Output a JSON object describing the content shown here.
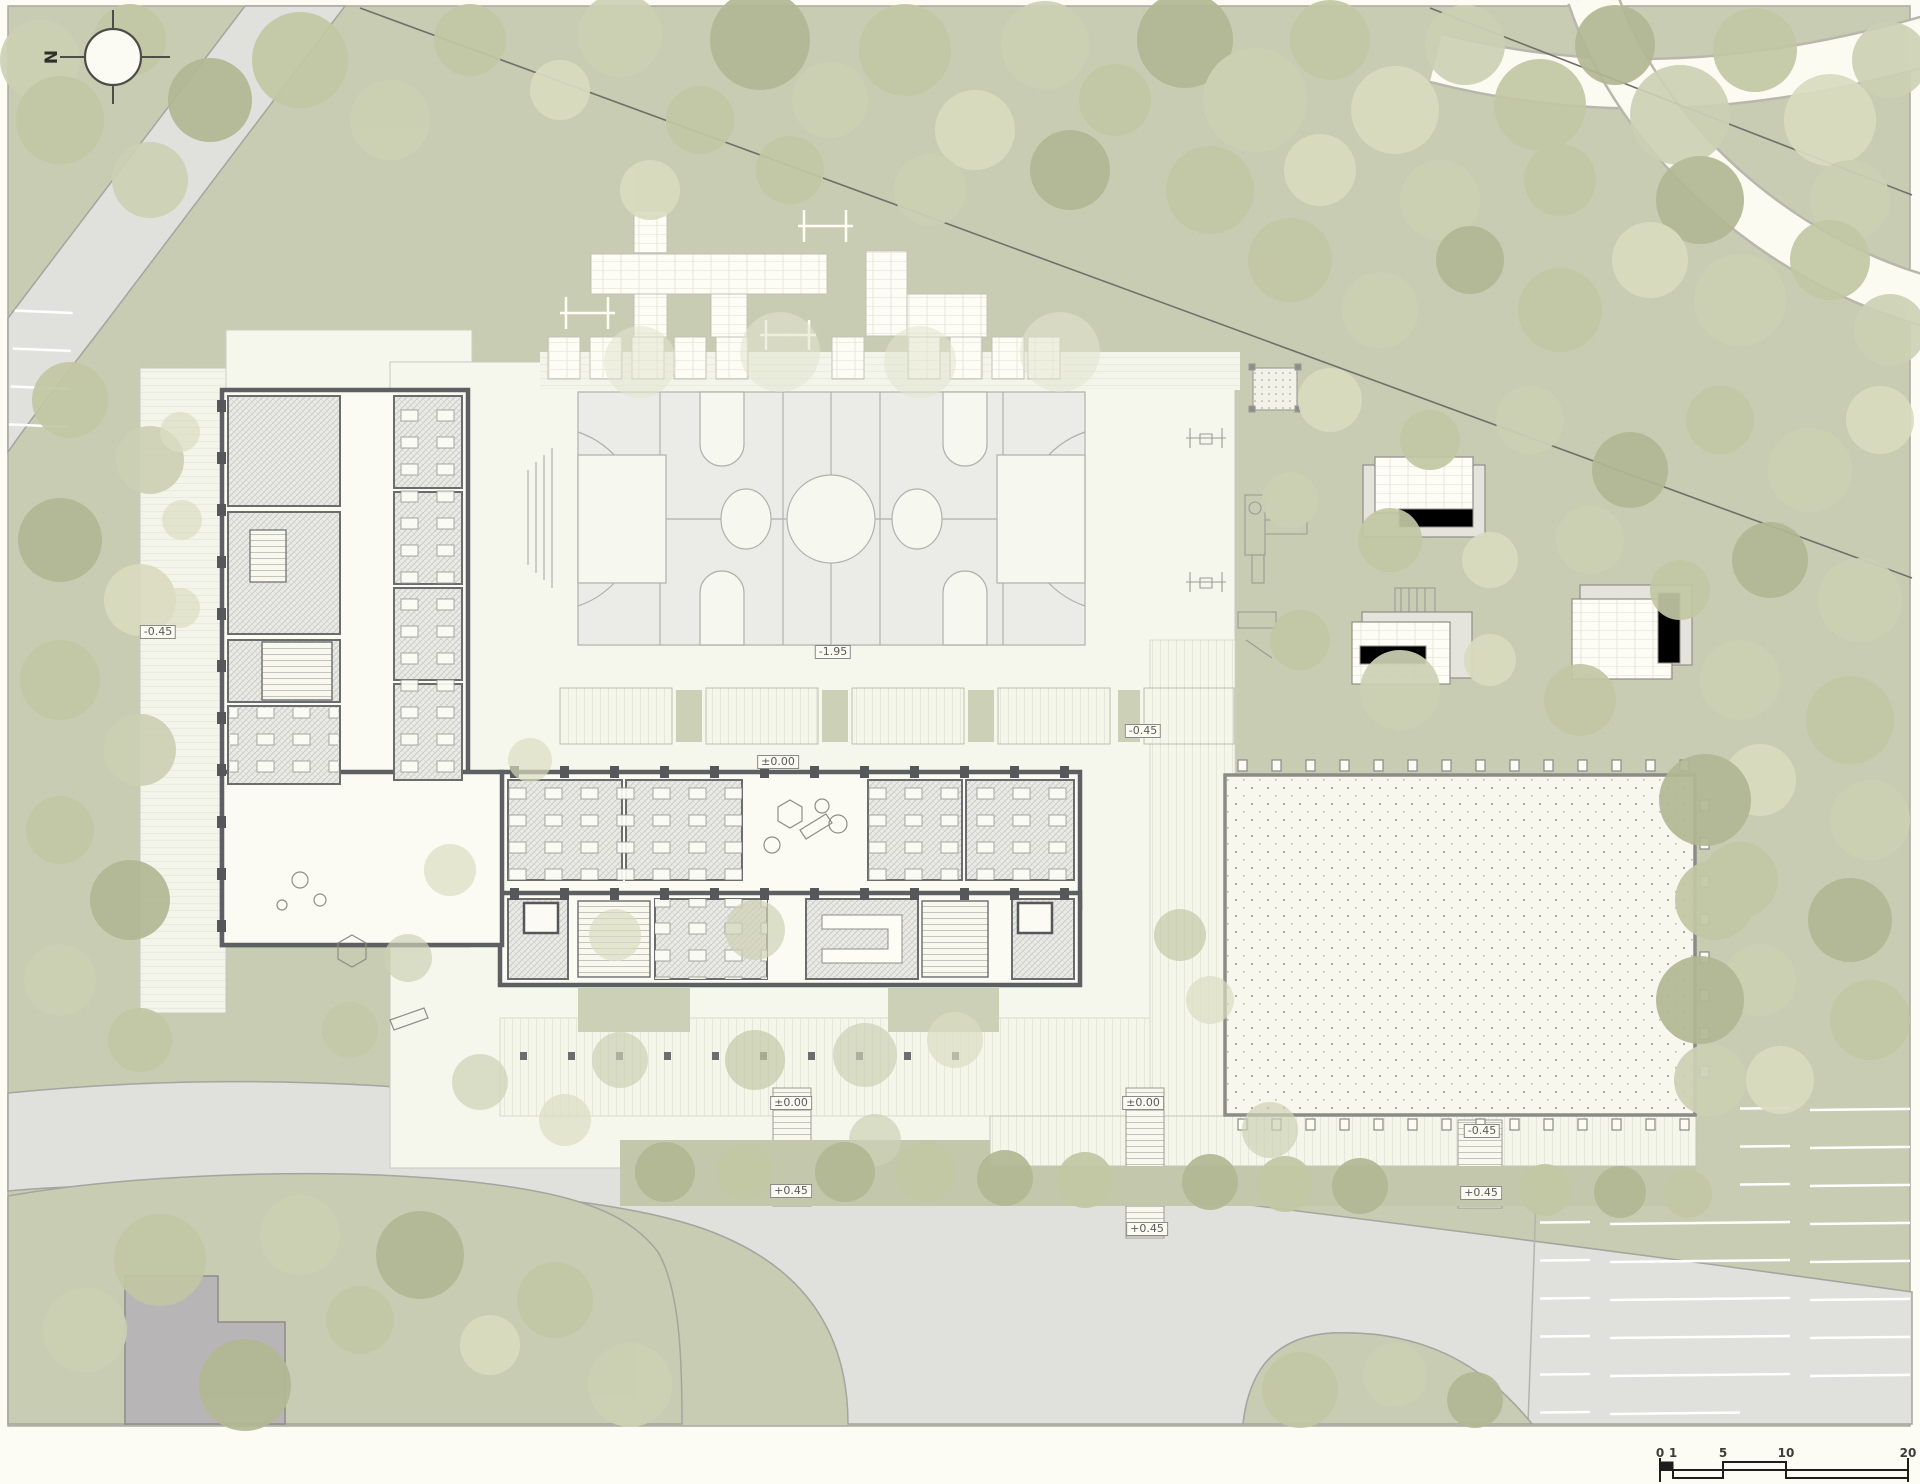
{
  "plan": {
    "type": "architectural-site-plan",
    "north": {
      "label": "N"
    },
    "colors": {
      "site_green": "#c8ccb2",
      "paving_ivory": "#f6f7ec",
      "road_gray": "#e0e1dc",
      "court_gray": "#ebece8",
      "wall_dark": "#5d5f62",
      "tree_olive": "#b2b894",
      "neighbor_building_gray": "#b8b5b6",
      "paper": "#fcfcf4"
    },
    "elevation_labels": [
      {
        "id": "west-forecourt",
        "text": "-0.45",
        "x": 158,
        "y": 632
      },
      {
        "id": "sports-court",
        "text": "-1.95",
        "x": 833,
        "y": 652
      },
      {
        "id": "east-walkway",
        "text": "-0.45",
        "x": 1143,
        "y": 731
      },
      {
        "id": "north-terrace",
        "text": "±0.00",
        "x": 778,
        "y": 762
      },
      {
        "id": "south-ramp-1-top",
        "text": "±0.00",
        "x": 791,
        "y": 1103
      },
      {
        "id": "south-ramp-1-bottom",
        "text": "+0.45",
        "x": 791,
        "y": 1191
      },
      {
        "id": "south-ramp-2-top",
        "text": "±0.00",
        "x": 1143,
        "y": 1103
      },
      {
        "id": "south-ramp-2-bottom",
        "text": "+0.45",
        "x": 1147,
        "y": 1229
      },
      {
        "id": "canopy-walkway",
        "text": "-0.45",
        "x": 1482,
        "y": 1131
      },
      {
        "id": "south-ramp-3",
        "text": "+0.45",
        "x": 1481,
        "y": 1193
      }
    ],
    "scale_bar": {
      "units": "m",
      "ticks": [
        {
          "label": "0",
          "x": 1660
        },
        {
          "label": "1",
          "x": 1673
        },
        {
          "label": "5",
          "x": 1723
        },
        {
          "label": "10",
          "x": 1786
        },
        {
          "label": "20",
          "x": 1908
        }
      ]
    }
  }
}
